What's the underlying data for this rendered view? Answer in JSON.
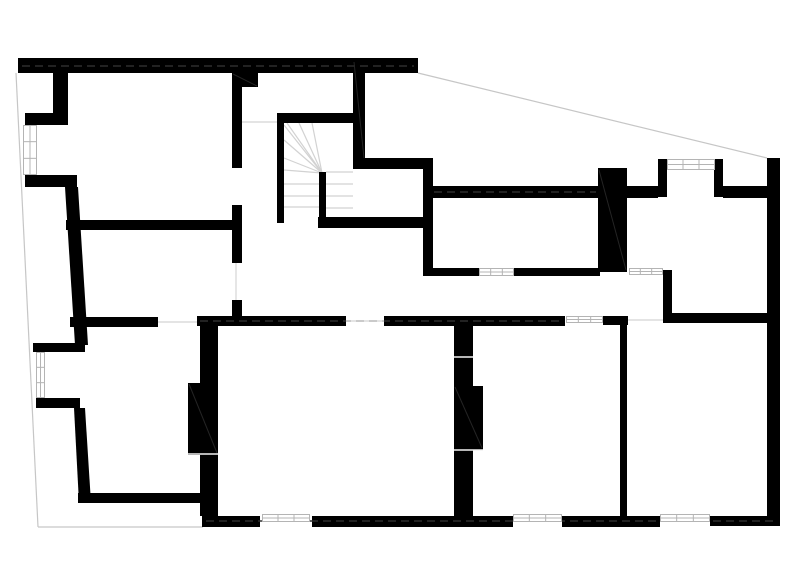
{
  "page": {
    "kind": "architectural-floor-plan",
    "background": "#ffffff"
  },
  "plan": {
    "width": 800,
    "height": 583,
    "colors": {
      "wall": "#000000",
      "boundary": "#c6c6c6",
      "tread": "#d2d2d2",
      "threshold": "#dcdcdc",
      "window_border": "#b4b4b4",
      "window_fill": "#ffffff",
      "dash": "#2e2e2e",
      "joint": "#f2f2f2",
      "hatch": "#242424"
    },
    "walls": [
      {
        "name": "exterior-wall-top",
        "x": 18,
        "y": 58,
        "w": 400,
        "h": 15
      },
      {
        "name": "exterior-wall-left-upper",
        "x": 53,
        "y": 73,
        "w": 15,
        "h": 43
      },
      {
        "name": "exterior-wall-left-jog-1",
        "x": 25,
        "y": 113,
        "w": 43,
        "h": 12
      },
      {
        "name": "exterior-wall-left-jog-2",
        "x": 25,
        "y": 175,
        "w": 52,
        "h": 12
      },
      {
        "name": "exterior-wall-left-jog-3",
        "x": 33,
        "y": 343,
        "w": 52,
        "h": 9
      },
      {
        "name": "exterior-wall-left-jog-4",
        "x": 36,
        "y": 398,
        "w": 44,
        "h": 10
      },
      {
        "name": "room-wall-bottom-left",
        "x": 78,
        "y": 493,
        "w": 140,
        "h": 10
      },
      {
        "name": "interior-wall-vertical-a",
        "x": 232,
        "y": 73,
        "w": 10,
        "h": 95
      },
      {
        "name": "interior-wall-notch",
        "x": 232,
        "y": 73,
        "w": 26,
        "h": 14
      },
      {
        "name": "interior-wall-vertical-b",
        "x": 232,
        "y": 205,
        "w": 10,
        "h": 58
      },
      {
        "name": "interior-wall-vertical-c",
        "x": 232,
        "y": 300,
        "w": 10,
        "h": 22
      },
      {
        "name": "interior-wall-horizontal-left",
        "x": 66,
        "y": 220,
        "w": 171,
        "h": 10
      },
      {
        "name": "stair-wall-left",
        "x": 277,
        "y": 113,
        "w": 7,
        "h": 110
      },
      {
        "name": "stair-wall-top",
        "x": 277,
        "y": 113,
        "w": 86,
        "h": 10
      },
      {
        "name": "stair-wall-right",
        "x": 353,
        "y": 60,
        "w": 12,
        "h": 100
      },
      {
        "name": "stair-landing-wall",
        "x": 353,
        "y": 158,
        "w": 80,
        "h": 11
      },
      {
        "name": "interior-wall-vertical-d",
        "x": 423,
        "y": 158,
        "w": 10,
        "h": 117
      },
      {
        "name": "stair-wall-bottom",
        "x": 318,
        "y": 217,
        "w": 114,
        "h": 11
      },
      {
        "name": "stair-stringer",
        "x": 319,
        "y": 172,
        "w": 7,
        "h": 46
      },
      {
        "name": "spine-wall-east-1",
        "x": 432,
        "y": 186,
        "w": 166,
        "h": 12
      },
      {
        "name": "chimney-pillar",
        "x": 598,
        "y": 168,
        "w": 29,
        "h": 104
      },
      {
        "name": "spine-wall-east-2",
        "x": 627,
        "y": 186,
        "w": 31,
        "h": 12
      },
      {
        "name": "bay-wall-left",
        "x": 658,
        "y": 159,
        "w": 9,
        "h": 38
      },
      {
        "name": "bay-wall-right",
        "x": 714,
        "y": 159,
        "w": 9,
        "h": 38
      },
      {
        "name": "spine-wall-east-3",
        "x": 723,
        "y": 186,
        "w": 44,
        "h": 12
      },
      {
        "name": "exterior-wall-right",
        "x": 767,
        "y": 158,
        "w": 13,
        "h": 368
      },
      {
        "name": "wall-mid-horizontal-1",
        "x": 423,
        "y": 268,
        "w": 56,
        "h": 8
      },
      {
        "name": "wall-mid-horizontal-2",
        "x": 514,
        "y": 268,
        "w": 86,
        "h": 8
      },
      {
        "name": "wall-vertical-e",
        "x": 663,
        "y": 270,
        "w": 9,
        "h": 48
      },
      {
        "name": "wall-right-room-top",
        "x": 663,
        "y": 313,
        "w": 117,
        "h": 10
      },
      {
        "name": "spine-wall-main-1",
        "x": 70,
        "y": 317,
        "w": 88,
        "h": 10
      },
      {
        "name": "spine-wall-main-2",
        "x": 197,
        "y": 316,
        "w": 149,
        "h": 10
      },
      {
        "name": "spine-wall-main-3",
        "x": 384,
        "y": 316,
        "w": 181,
        "h": 10
      },
      {
        "name": "spine-wall-main-4",
        "x": 603,
        "y": 316,
        "w": 25,
        "h": 9
      },
      {
        "name": "partition-wall-left",
        "x": 200,
        "y": 320,
        "w": 18,
        "h": 196
      },
      {
        "name": "partition-block-left",
        "x": 188,
        "y": 383,
        "w": 30,
        "h": 72
      },
      {
        "name": "partition-wall-mid",
        "x": 454,
        "y": 325,
        "w": 19,
        "h": 191
      },
      {
        "name": "partition-block-mid",
        "x": 454,
        "y": 386,
        "w": 29,
        "h": 64
      },
      {
        "name": "partition-wall-right",
        "x": 620,
        "y": 324,
        "w": 7,
        "h": 192
      },
      {
        "name": "exterior-wall-bottom-1",
        "x": 202,
        "y": 516,
        "w": 58,
        "h": 11
      },
      {
        "name": "exterior-wall-bottom-2",
        "x": 312,
        "y": 516,
        "w": 201,
        "h": 11
      },
      {
        "name": "exterior-wall-bottom-3",
        "x": 562,
        "y": 516,
        "w": 98,
        "h": 11
      },
      {
        "name": "exterior-wall-bottom-4",
        "x": 710,
        "y": 516,
        "w": 70,
        "h": 10
      }
    ],
    "polygons": [
      {
        "name": "exterior-wall-left-mid",
        "points": "65,187 78,187 88,345 75,345"
      },
      {
        "name": "exterior-wall-left-lower",
        "points": "74,408 85,408 91,503 79,503"
      }
    ],
    "boundary_lines": [
      {
        "name": "site-boundary-left",
        "x1": 16,
        "y1": 73,
        "x2": 38,
        "y2": 527
      },
      {
        "name": "site-boundary-bottom",
        "x1": 38,
        "y1": 527,
        "x2": 203,
        "y2": 527
      },
      {
        "name": "roof-edge-diagonal",
        "x1": 418,
        "y1": 73,
        "x2": 767,
        "y2": 158
      }
    ],
    "threshold_lines": [
      {
        "name": "door-threshold-corridor",
        "x1": 242,
        "y1": 122,
        "x2": 277,
        "y2": 122
      },
      {
        "name": "door-leaf-left-room",
        "x1": 236,
        "y1": 263,
        "x2": 236,
        "y2": 300
      },
      {
        "name": "door-threshold-spine-1",
        "x1": 158,
        "y1": 322,
        "x2": 197,
        "y2": 322
      },
      {
        "name": "door-threshold-spine-2",
        "x1": 346,
        "y1": 321,
        "x2": 384,
        "y2": 321
      },
      {
        "name": "door-threshold-right",
        "x1": 628,
        "y1": 320,
        "x2": 663,
        "y2": 320
      }
    ],
    "dash_lines": [
      {
        "name": "wall-centerline-top",
        "x1": 22,
        "y1": 66,
        "x2": 414,
        "y2": 66
      },
      {
        "name": "wall-centerline-spine",
        "x1": 200,
        "y1": 321,
        "x2": 562,
        "y2": 321
      },
      {
        "name": "wall-centerline-east",
        "x1": 434,
        "y1": 192,
        "x2": 596,
        "y2": 192
      },
      {
        "name": "wall-centerline-bottom",
        "x1": 206,
        "y1": 521,
        "x2": 776,
        "y2": 521
      }
    ],
    "joint_lines": [
      {
        "name": "wall-joint-mid-1",
        "x1": 454,
        "y1": 357,
        "x2": 473,
        "y2": 357
      },
      {
        "name": "wall-joint-mid-2",
        "x1": 454,
        "y1": 450,
        "x2": 483,
        "y2": 450
      },
      {
        "name": "wall-joint-left",
        "x1": 188,
        "y1": 454,
        "x2": 218,
        "y2": 454
      }
    ],
    "hatch_lines": [
      {
        "name": "hatch-chimney",
        "x1": 599,
        "y1": 170,
        "x2": 626,
        "y2": 270
      },
      {
        "name": "hatch-block-left",
        "x1": 189,
        "y1": 384,
        "x2": 217,
        "y2": 453
      },
      {
        "name": "hatch-block-mid",
        "x1": 455,
        "y1": 387,
        "x2": 482,
        "y2": 448
      },
      {
        "name": "hatch-notch",
        "x1": 233,
        "y1": 74,
        "x2": 257,
        "y2": 86
      },
      {
        "name": "hatch-stair-wall",
        "x1": 354,
        "y1": 62,
        "x2": 364,
        "y2": 158
      }
    ],
    "windows": [
      {
        "name": "window-left-upper",
        "x": 23,
        "y": 125,
        "w": 14,
        "h": 50
      },
      {
        "name": "window-left-lower",
        "x": 36,
        "y": 352,
        "w": 9,
        "h": 46
      },
      {
        "name": "window-bay-north",
        "x": 667,
        "y": 159,
        "w": 48,
        "h": 11
      },
      {
        "name": "window-mid-1",
        "x": 479,
        "y": 268,
        "w": 35,
        "h": 8
      },
      {
        "name": "window-mid-2",
        "x": 629,
        "y": 268,
        "w": 34,
        "h": 7
      },
      {
        "name": "window-spine",
        "x": 566,
        "y": 316,
        "w": 37,
        "h": 7
      },
      {
        "name": "window-south-1",
        "x": 262,
        "y": 514,
        "w": 48,
        "h": 8
      },
      {
        "name": "window-south-2",
        "x": 513,
        "y": 514,
        "w": 49,
        "h": 8
      },
      {
        "name": "window-south-3",
        "x": 660,
        "y": 514,
        "w": 50,
        "h": 8
      }
    ],
    "stair": {
      "fan": {
        "cx": 322,
        "cy": 173,
        "targets": [
          [
            284,
            125
          ],
          [
            284,
            140
          ],
          [
            284,
            158
          ],
          [
            284,
            170
          ],
          [
            287,
            123
          ],
          [
            299,
            123
          ],
          [
            312,
            123
          ]
        ]
      },
      "treads": [
        {
          "x1": 326,
          "y1": 172,
          "x2": 353,
          "y2": 172
        },
        {
          "x1": 326,
          "y1": 184,
          "x2": 353,
          "y2": 184
        },
        {
          "x1": 326,
          "y1": 196,
          "x2": 353,
          "y2": 196
        },
        {
          "x1": 326,
          "y1": 208,
          "x2": 353,
          "y2": 208
        },
        {
          "x1": 284,
          "y1": 184,
          "x2": 319,
          "y2": 184
        },
        {
          "x1": 284,
          "y1": 196,
          "x2": 319,
          "y2": 196
        },
        {
          "x1": 284,
          "y1": 207,
          "x2": 319,
          "y2": 207
        }
      ]
    }
  }
}
